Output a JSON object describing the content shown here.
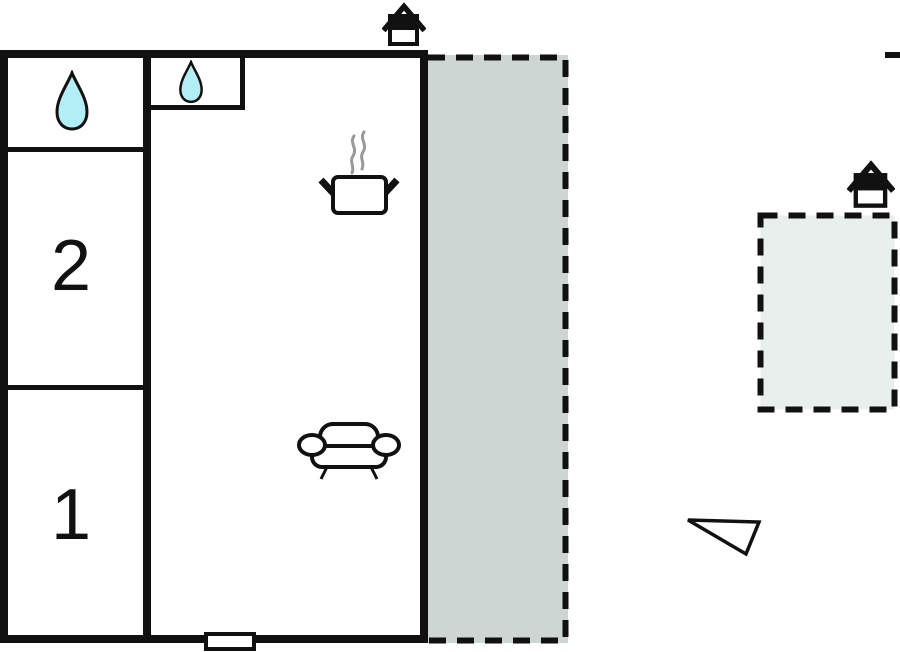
{
  "plan": {
    "rooms": {
      "bedroom1": {
        "label": "1"
      },
      "bedroom2": {
        "label": "2"
      }
    }
  },
  "icons": {
    "water_drop_large": "water-drop",
    "water_drop_small": "water-drop",
    "cooking_pot": "cooking-pot-with-steam",
    "sofa": "sofa",
    "house_entrance_main": "house-entrance",
    "house_entrance_annex": "house-entrance",
    "direction_marker": "triangle-pointer",
    "door": "door-opening"
  },
  "colors": {
    "wall": "#111111",
    "terrace_fill": "#cdd6d3",
    "annex_fill": "#e9efed",
    "water": "#b3eef6",
    "steam": "#999999",
    "background": "#ffffff"
  }
}
